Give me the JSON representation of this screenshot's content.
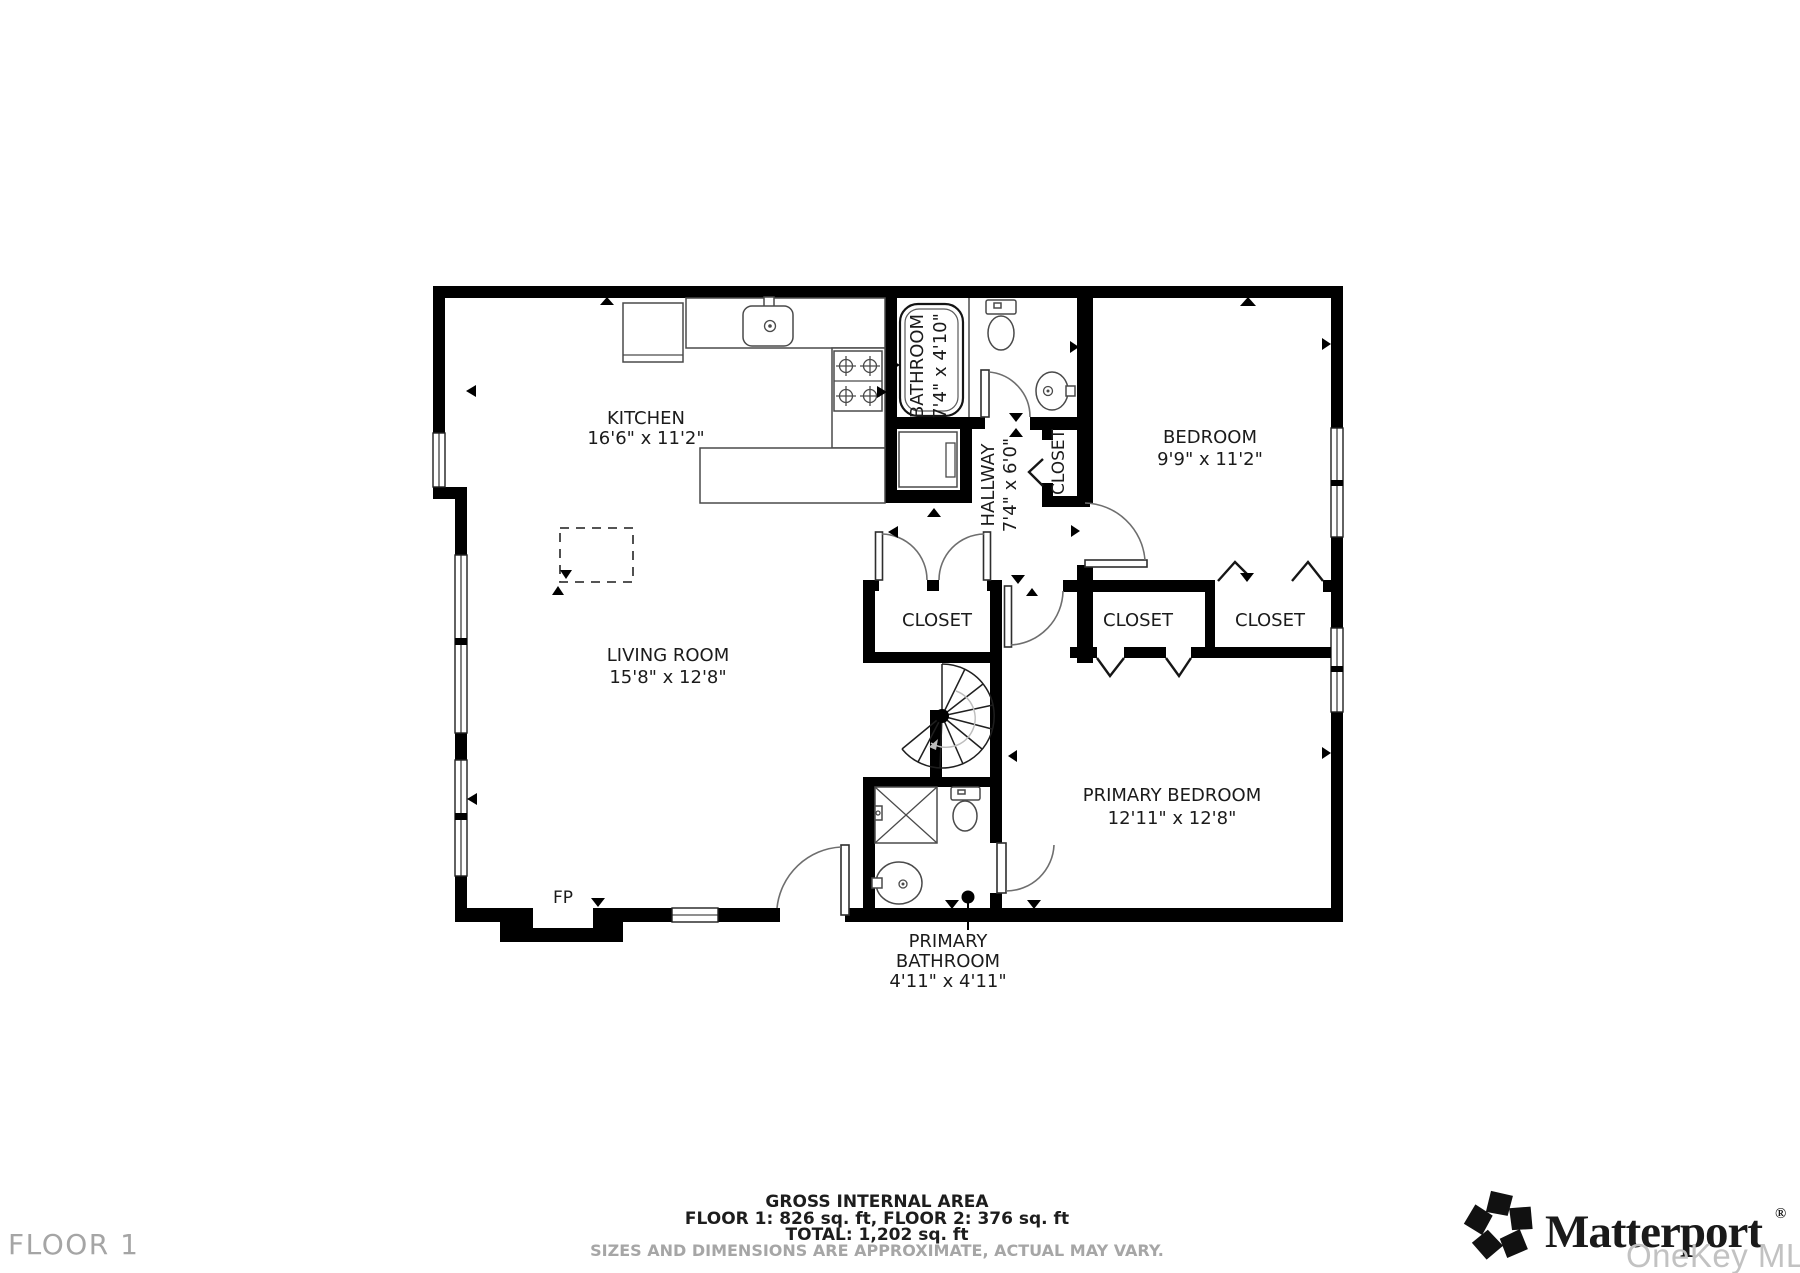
{
  "rooms": {
    "kitchen": {
      "name": "KITCHEN",
      "dims": "16'6\" x 11'2\""
    },
    "living_room": {
      "name": "LIVING ROOM",
      "dims": "15'8\" x 12'8\""
    },
    "bathroom": {
      "name": "BATHROOM",
      "dims": "7'4\" x 4'10\""
    },
    "hallway": {
      "name": "HALLWAY",
      "dims": "7'4\" x 6'0\""
    },
    "bedroom": {
      "name": "BEDROOM",
      "dims": "9'9\" x 11'2\""
    },
    "primary_bedroom": {
      "name": "PRIMARY BEDROOM",
      "dims": "12'11\" x 12'8\""
    },
    "primary_bathroom": {
      "line1": "PRIMARY",
      "line2": "BATHROOM",
      "dims": "4'11\" x 4'11\""
    },
    "closet_hall": {
      "name": "CLOSET"
    },
    "closet_main": {
      "name": "CLOSET"
    },
    "closet_primary": {
      "name": "CLOSET"
    },
    "closet_bedroom": {
      "name": "CLOSET"
    },
    "fireplace": {
      "abbr": "FP"
    }
  },
  "footer": {
    "area_title": "GROSS INTERNAL AREA",
    "area_floors": "FLOOR 1: 826 sq. ft, FLOOR 2: 376 sq. ft",
    "area_total": "TOTAL: 1,202 sq. ft",
    "disclaimer": "SIZES AND DIMENSIONS ARE APPROXIMATE, ACTUAL MAY VARY.",
    "floor_label": "FLOOR 1"
  },
  "brand": {
    "name": "Matterport",
    "registered": "®",
    "watermark": "OneKey MLS"
  },
  "colors": {
    "wall": "#000000",
    "label_text": "#1b1b1b",
    "muted_text": "#a5a5a5",
    "watermark_text": "#c2c2c2"
  }
}
